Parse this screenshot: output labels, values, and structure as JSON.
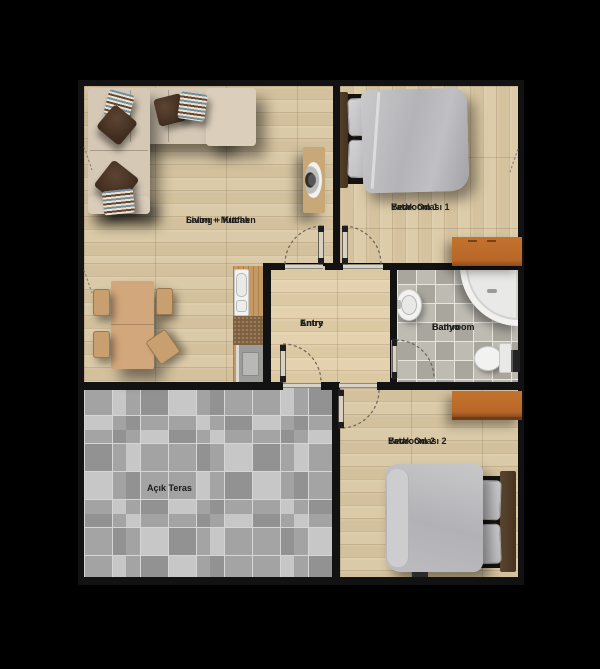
{
  "rooms": {
    "living": {
      "name_tr": "Salon + Mutfak",
      "name_en": "Living + Kitchen"
    },
    "bedroom1": {
      "name_tr": "Yatak Odası 1",
      "name_en": "Bedroom 1"
    },
    "entry": {
      "name_tr": "Antre",
      "name_en": "Entry"
    },
    "bathroom": {
      "name_tr": "Banyo",
      "name_en": "Bathroom"
    },
    "bedroom2": {
      "name_tr": "Yatak Odası 2",
      "name_en": "Bedroom 2"
    },
    "terrace": {
      "name_tr": "Açık Teras"
    }
  },
  "furniture": {
    "living": [
      "corner-sofa",
      "throw-pillows",
      "tv-unit",
      "dining-table",
      "chairs",
      "kitchen-counter",
      "kitchen-sink",
      "oven"
    ],
    "bedroom1": [
      "double-bed",
      "pillows",
      "dresser"
    ],
    "bathroom": [
      "corner-bathtub",
      "washbasin",
      "toilet",
      "radiator"
    ],
    "bedroom2": [
      "double-bed",
      "pillows",
      "dresser"
    ]
  },
  "colors": {
    "background": "#000000",
    "wall": "#121212",
    "wood_floor": "#d7c6a3",
    "terrace_tile": "#b4b4b4",
    "bathroom_tile": "#b6b3a9",
    "sofa": "#d5c8b5",
    "bedding_gray": "#b9b9bd",
    "dresser_orange": "#bf6c2a",
    "label_text": "#1b1b1b"
  }
}
